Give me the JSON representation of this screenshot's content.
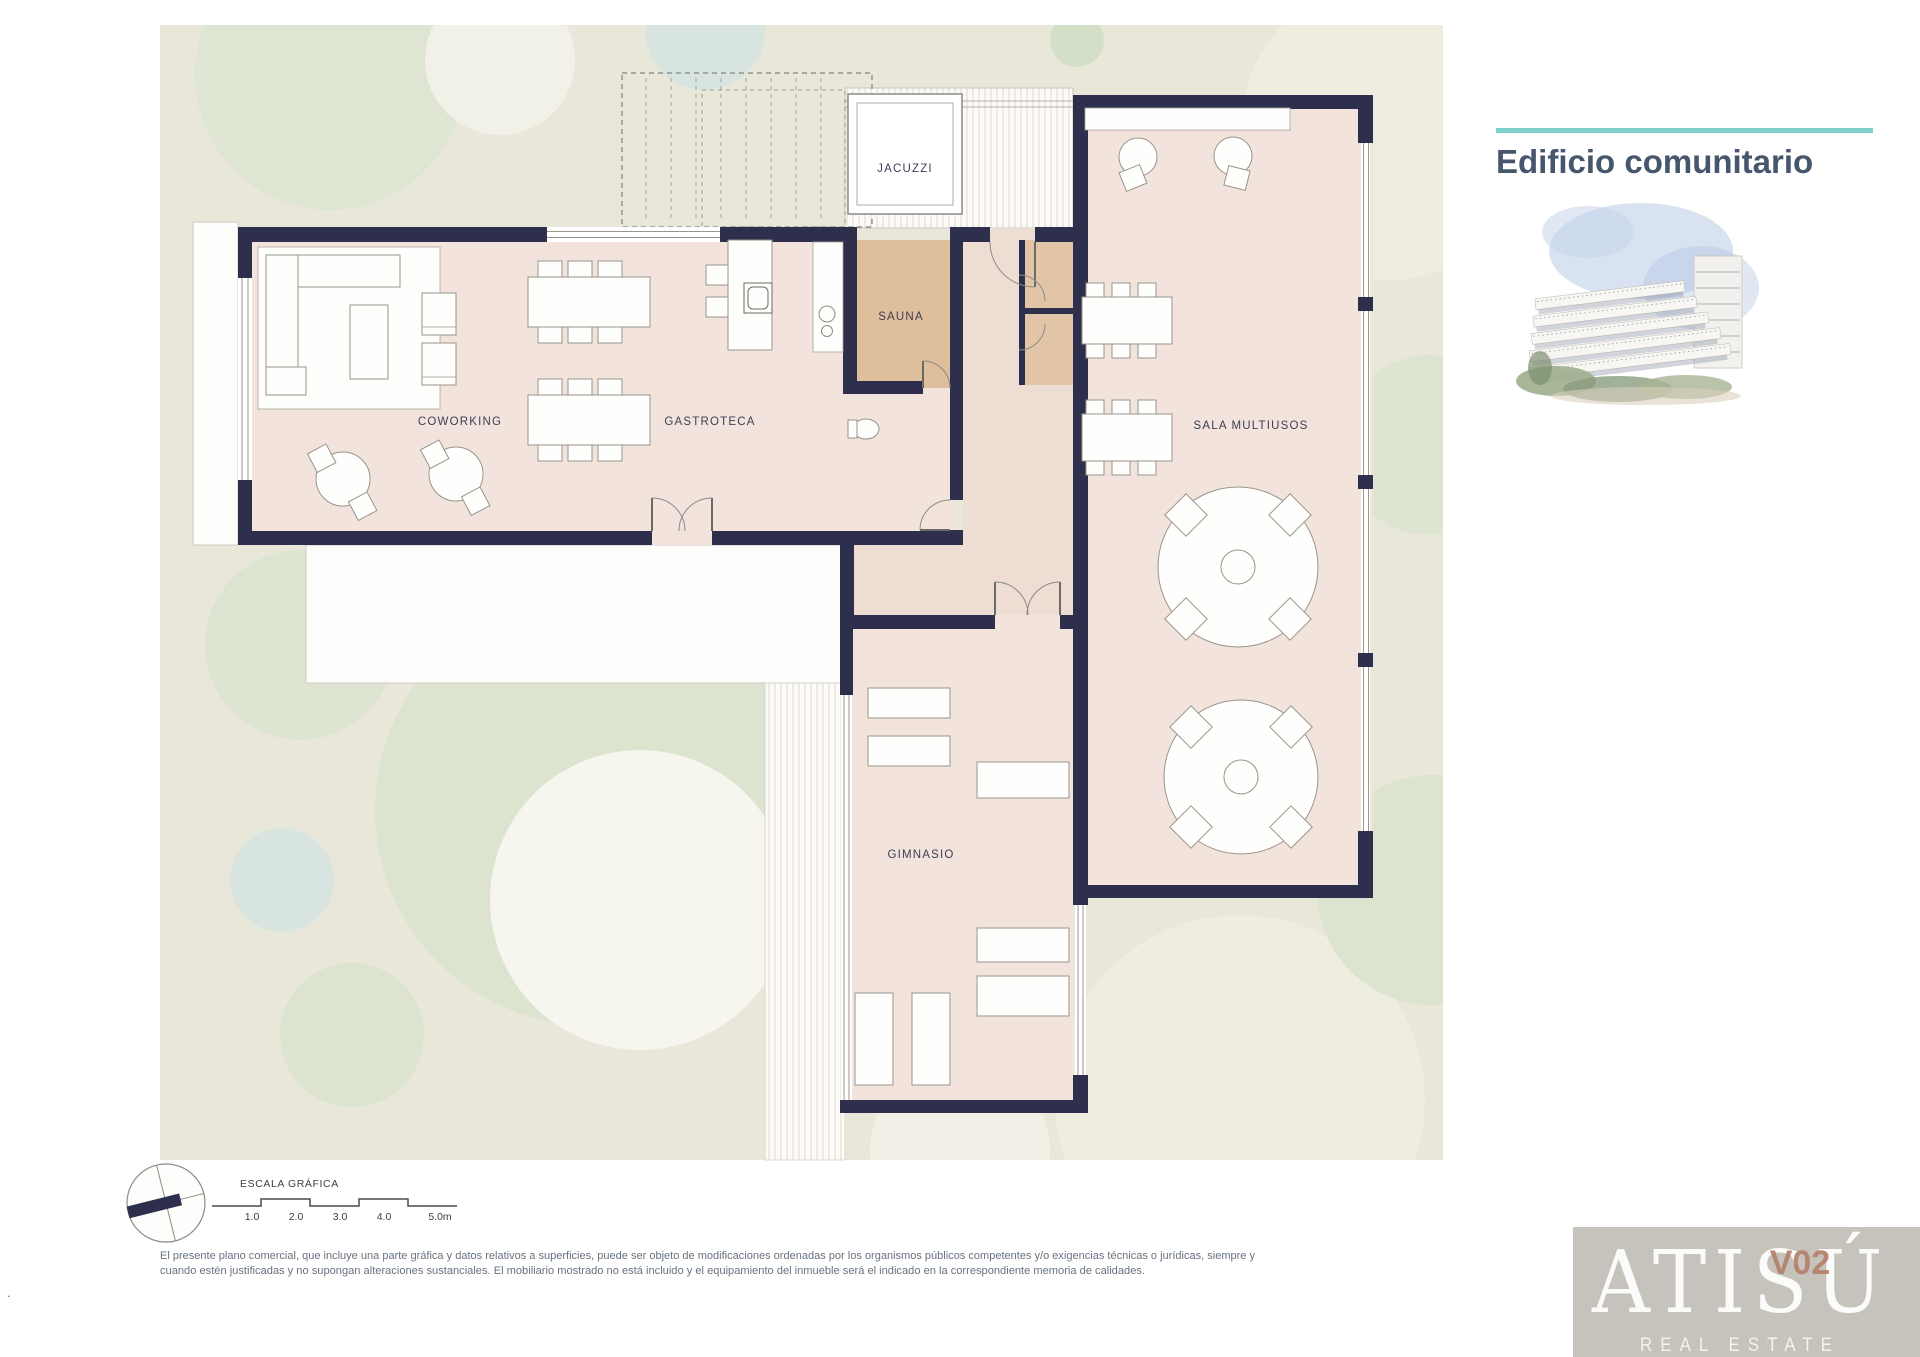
{
  "title_block": {
    "title": "Edificio comunitario"
  },
  "plan": {
    "rooms": [
      {
        "id": "jacuzzi",
        "name": "JACUZZI"
      },
      {
        "id": "sauna",
        "name": "SAUNA"
      },
      {
        "id": "coworking",
        "name": "COWORKING"
      },
      {
        "id": "gastroteca",
        "name": "GASTROTECA"
      },
      {
        "id": "sala-multiusos",
        "name": "SALA MULTIUSOS"
      },
      {
        "id": "gimnasio",
        "name": "GIMNASIO"
      }
    ]
  },
  "scale_bar": {
    "label": "ESCALA GRÁFICA",
    "ticks": [
      "1.0",
      "2.0",
      "3.0",
      "4.0",
      "5.0m"
    ]
  },
  "disclaimer": {
    "line1": "El presente plano comercial, que incluye una parte gráfica y datos relativos a superficies, puede ser objeto de modificaciones ordenadas por los organismos públicos competentes y/o exigencias técnicas o jurídicas, siempre y",
    "line2": "cuando estén justificadas y no supongan alteraciones sustanciales. El mobiliario mostrado no está incluido y el equipamiento del inmueble será el indicado en la correspondiente memoria de calidades."
  },
  "logo": {
    "brand": "ATISÚ",
    "version": "V02",
    "tagline": "REAL ESTATE"
  },
  "footer_mark": ".",
  "colors": {
    "accent": "#7ed0cb",
    "wall": "#2d2f4c",
    "floor": "#f2e4dc",
    "floor_warm": "#eeddd2",
    "sauna": "#dfbe9b",
    "closet": "#e2c5a7",
    "label": "#3b3d57",
    "title": "#46566c",
    "disclaimer": "#67737f",
    "logo_bg": "#c6c3bd",
    "logo_text": "#fbfbf9",
    "version": "#b5806b"
  }
}
